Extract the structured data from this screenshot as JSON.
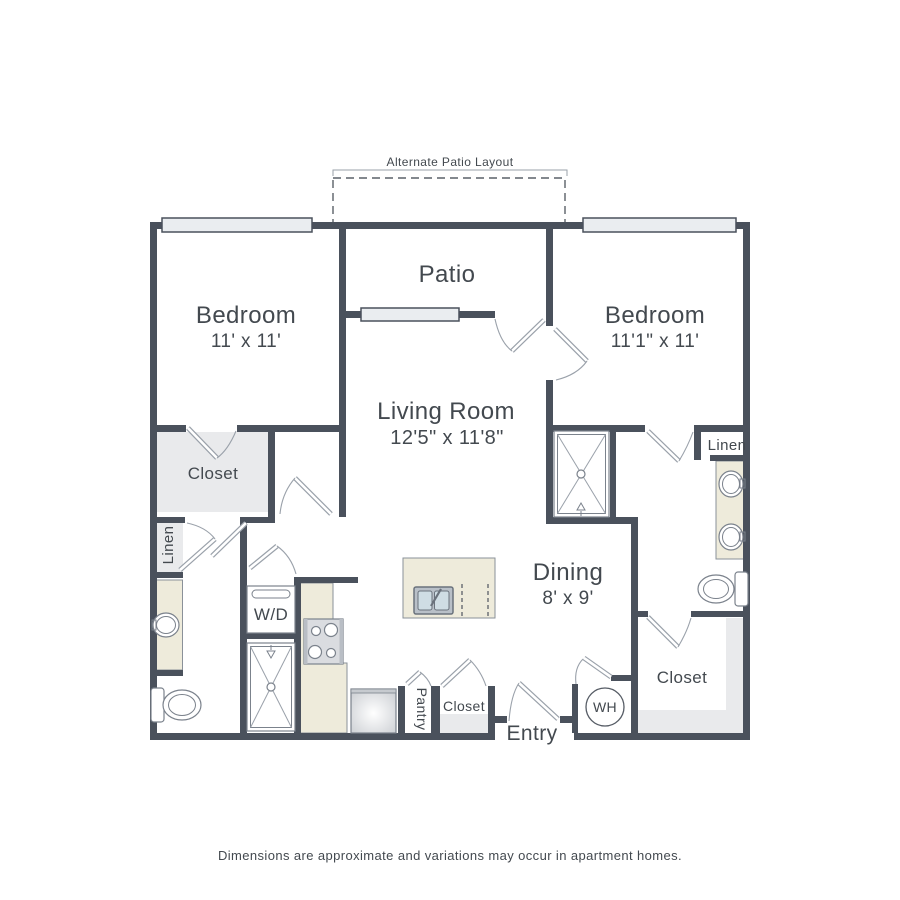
{
  "colors": {
    "wall": "#4a515c",
    "text": "#43494f",
    "counter": "#eeebdb",
    "counter_edge": "#8a9199",
    "closet_fill": "#e9eaec",
    "window_fill": "#eaedf0",
    "fixture_line": "#7b828c",
    "door_line": "#9aa1aa",
    "sink_fill": "#cfdde4",
    "appliance_fill": "#dadce0"
  },
  "annotations": {
    "alt_patio_label": "Alternate Patio Layout"
  },
  "rooms": {
    "patio": {
      "name": "Patio"
    },
    "bedroom_left": {
      "name": "Bedroom",
      "dims": "11' x 11'"
    },
    "bedroom_right": {
      "name": "Bedroom",
      "dims": "11'1\" x 11'"
    },
    "living": {
      "name": "Living Room",
      "dims": "12'5\" x 11'8\""
    },
    "dining": {
      "name": "Dining",
      "dims": "8' x 9'"
    },
    "entry": {
      "name": "Entry"
    },
    "closet_bedroom_left": {
      "name": "Closet"
    },
    "closet_hall": {
      "name": "Closet"
    },
    "closet_bedroom_right": {
      "name": "Closet"
    },
    "linen_left": {
      "name": "Linen"
    },
    "linen_right": {
      "name": "Linen"
    },
    "pantry": {
      "name": "Pantry"
    },
    "laundry": {
      "name": "W/D"
    },
    "water_heater": {
      "name": "WH"
    }
  },
  "footer": {
    "disclaimer": "Dimensions are approximate and variations may occur in apartment homes."
  }
}
